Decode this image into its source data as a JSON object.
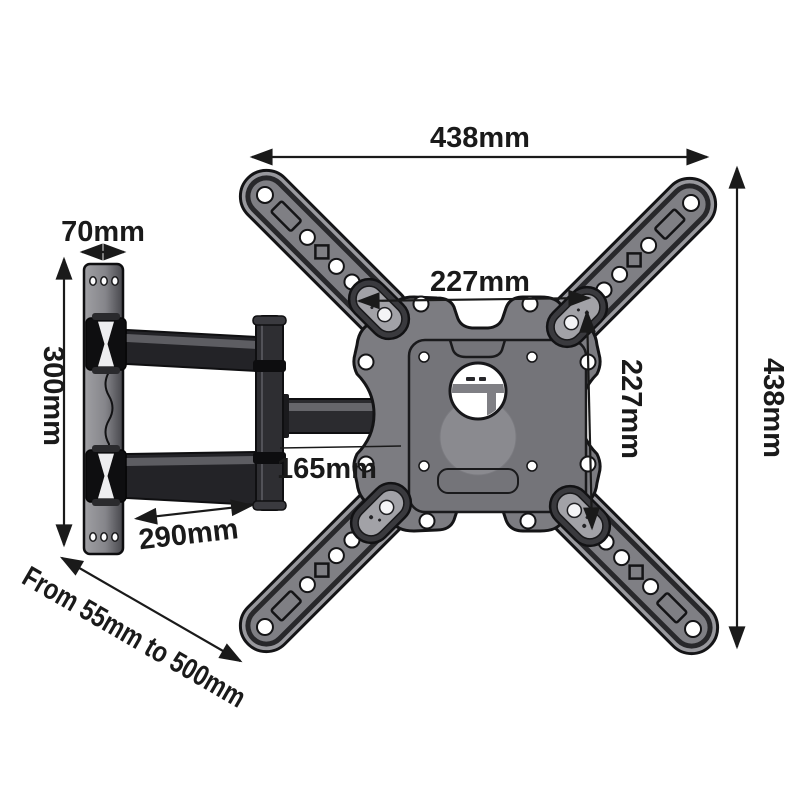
{
  "title": "Full-motion TV wall mount dimension diagram",
  "colors": {
    "background": "#ffffff",
    "annotation": "#1a1a1a",
    "metal_dark": "#1c1c1f",
    "metal_mid": "#7c7c81",
    "metal_light": "#98989d",
    "plate_inner": "#747479",
    "pod_inset": "#a2a2a7"
  },
  "dimensions": {
    "top_width": "438mm",
    "side_height": "438mm",
    "vesa_width": "227mm",
    "vesa_height": "227mm",
    "wall_plate_width": "70mm",
    "wall_plate_height": "300mm",
    "arm_segment": "165mm",
    "arm_reach": "290mm",
    "extension_range": "From 55mm to 500mm"
  }
}
